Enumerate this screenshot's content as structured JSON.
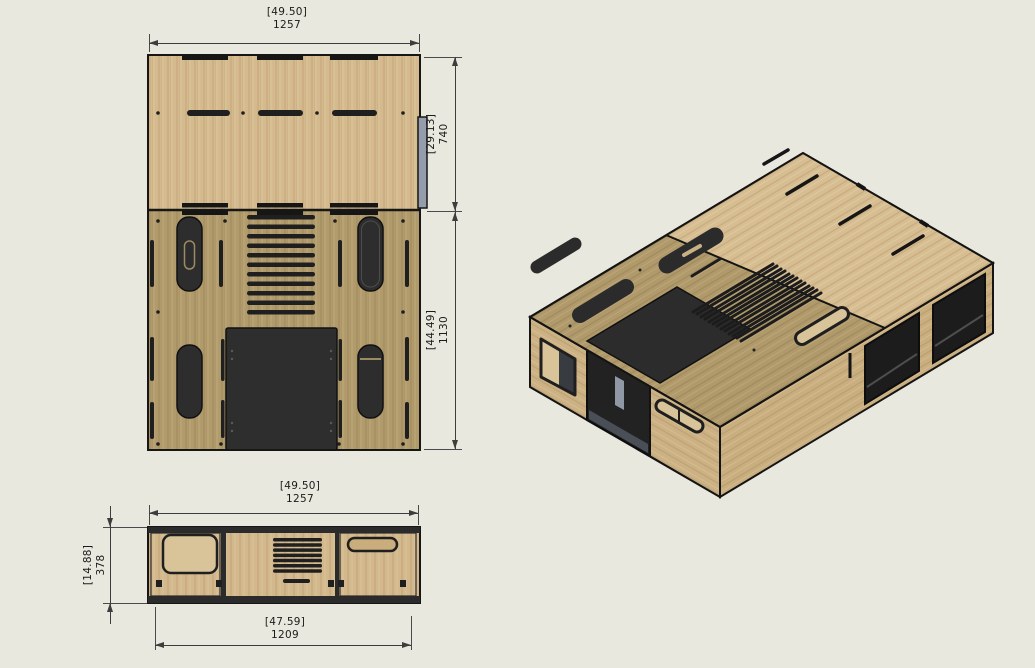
{
  "drawing": {
    "background_color": "#e9e8de",
    "views": {
      "top_view": {
        "dim_width": {
          "in": "[49.50]",
          "mm": "1257"
        },
        "dim_depth_upper": {
          "in": "[29.13]",
          "mm": "740"
        },
        "dim_depth_lower": {
          "in": "[44.49]",
          "mm": "1130"
        }
      },
      "front_view": {
        "dim_width": {
          "in": "[49.50]",
          "mm": "1257"
        },
        "dim_height": {
          "in": "[14.88]",
          "mm": "378"
        },
        "dim_inner_width": {
          "in": "[47.59]",
          "mm": "1209"
        }
      }
    },
    "colors": {
      "wood_light": "#d4ba8e",
      "wood_olive": "#b19b6d",
      "wood_side_tan": "#cbb183",
      "panel_dark": "#2d2d2d",
      "opening_dark": "#1e1e1e",
      "outline": "#161616",
      "alignment_tab_gray": "#959cab",
      "floor_gray": "#4a4f57",
      "dimension_line": "#3d3d3d",
      "dimension_text": "#1b1b1b"
    }
  }
}
